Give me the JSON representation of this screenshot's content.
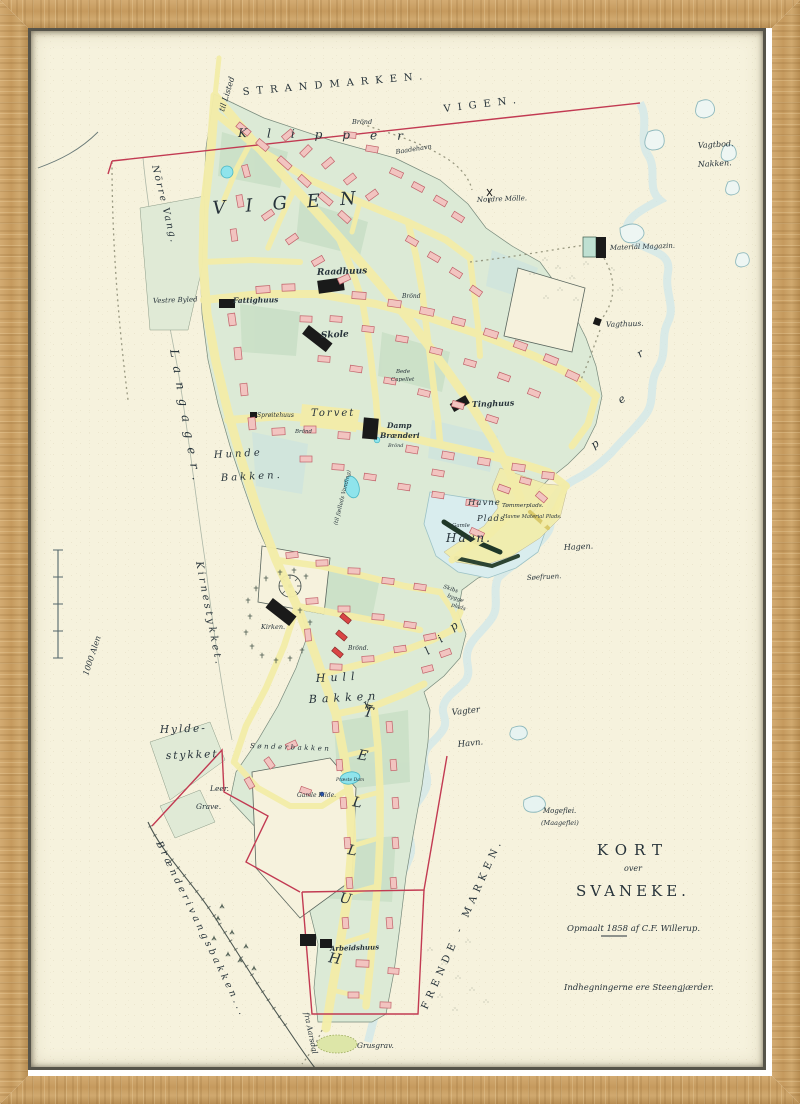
{
  "artwork": {
    "type": "framed antique town map",
    "town": "Svaneke",
    "year": "1858"
  },
  "palette": {
    "wood": "#c59a62",
    "paper": "#f6f2dd",
    "street": "#f3eda9",
    "block": "#dcead6",
    "block_dark": "#c9dfc6",
    "block_teal": "#cfe4dd",
    "building_pink": "#f2c4c0",
    "building_pink_stroke": "#c2626a",
    "building_red": "#d94545",
    "landmark_black": "#1a1a1a",
    "water_wash": "#cfe7ea",
    "water_line": "#8fb9bd",
    "boundary_red": "#c23a52",
    "pond_cyan": "#8fe4ec",
    "ink": "#27333a"
  },
  "scale_bar": {
    "label": "1000 Alen"
  },
  "title_block": {
    "line1": "KORT",
    "line2": "over",
    "line3": "SVANEKE.",
    "surveyed": "Opmaalt 1858 af C.F. Willerup.",
    "note": "Indhegningerne ere Steengjærder."
  },
  "map": {
    "labels": [
      {
        "id": "strandmarken",
        "text": "STRANDMARKEN.",
        "x": 243,
        "y": 95,
        "s": 10,
        "r": -5,
        "ls": 7,
        "c": "caps"
      },
      {
        "id": "til-listed",
        "text": "til Listed",
        "x": 224,
        "y": 112,
        "s": 8,
        "r": -73,
        "c": "script"
      },
      {
        "id": "klipper-north",
        "text": "Klipper",
        "x": 238,
        "y": 137,
        "s": 12,
        "r": 1,
        "ls": 20,
        "c": "ital"
      },
      {
        "id": "vigen-north",
        "text": "VIGEN.",
        "x": 444,
        "y": 112,
        "s": 10,
        "r": -7,
        "ls": 7,
        "c": "caps"
      },
      {
        "id": "brond-north",
        "text": "Brönd",
        "x": 352,
        "y": 124,
        "s": 6.5,
        "c": "script"
      },
      {
        "id": "baadehavn",
        "text": "Baadehavn",
        "x": 396,
        "y": 154,
        "s": 6.5,
        "r": -9,
        "c": "script"
      },
      {
        "id": "vagtbod",
        "text": "Vagtbod.",
        "x": 698,
        "y": 148,
        "s": 8,
        "r": -3,
        "c": "script"
      },
      {
        "id": "nakken",
        "text": "Nakken.",
        "x": 698,
        "y": 167,
        "s": 8,
        "r": -3,
        "c": "script"
      },
      {
        "id": "norre-vang",
        "text": "Nörre Vang.",
        "x": 152,
        "y": 166,
        "s": 9.5,
        "r": 76,
        "ls": 2,
        "c": "script"
      },
      {
        "id": "vigen-town",
        "text": "VIGEN",
        "x": 213,
        "y": 214,
        "s": 18,
        "r": -4,
        "ls": 20,
        "c": "ital"
      },
      {
        "id": "nordre-molle",
        "text": "Nordre Mölle.",
        "x": 477,
        "y": 202,
        "s": 7,
        "r": -2,
        "c": "script"
      },
      {
        "id": "material-magazin",
        "text": "Materiál Magazin.",
        "x": 610,
        "y": 250,
        "s": 7,
        "r": -2,
        "c": "script"
      },
      {
        "id": "langager",
        "text": "Langager.",
        "x": 170,
        "y": 350,
        "s": 12,
        "r": 80,
        "ls": 9,
        "c": "script"
      },
      {
        "id": "vagthuus",
        "text": "Vagthuus.",
        "x": 606,
        "y": 327,
        "s": 7.5,
        "r": -2,
        "c": "script"
      },
      {
        "id": "raadhuus",
        "text": "Raadhuus",
        "x": 317,
        "y": 275,
        "s": 9,
        "r": -2,
        "c": "scriptb"
      },
      {
        "id": "vestre-byled",
        "text": "Vestre Byled",
        "x": 153,
        "y": 303,
        "s": 7,
        "r": -2,
        "c": "script"
      },
      {
        "id": "fattighuus",
        "text": "Fattighuus",
        "x": 233,
        "y": 303,
        "s": 7.5,
        "r": -1,
        "c": "scriptb"
      },
      {
        "id": "skole",
        "text": "Skole",
        "x": 321,
        "y": 338,
        "s": 9,
        "r": -3,
        "c": "scriptb"
      },
      {
        "id": "brond-1",
        "text": "Brönd",
        "x": 402,
        "y": 298,
        "s": 6,
        "c": "script"
      },
      {
        "id": "bede",
        "text": "Bede",
        "x": 396,
        "y": 373,
        "s": 5.5,
        "c": "script"
      },
      {
        "id": "capellet",
        "text": "Capellet",
        "x": 391,
        "y": 381,
        "s": 5.5,
        "c": "script"
      },
      {
        "id": "sproitehuus",
        "text": "Sprøitehuus",
        "x": 257,
        "y": 417,
        "s": 6,
        "c": "script"
      },
      {
        "id": "torvet",
        "text": "Torvet",
        "x": 311,
        "y": 416,
        "s": 10,
        "ls": 2,
        "c": "ital"
      },
      {
        "id": "brond-2",
        "text": "Brönd",
        "x": 295,
        "y": 433,
        "s": 5.5,
        "c": "script"
      },
      {
        "id": "hunde",
        "text": "Hunde",
        "x": 214,
        "y": 458,
        "s": 10,
        "ls": 3,
        "r": -3,
        "c": "ital"
      },
      {
        "id": "bakken-1",
        "text": "Bakken.",
        "x": 221,
        "y": 481,
        "s": 10,
        "ls": 3,
        "r": -3,
        "c": "ital"
      },
      {
        "id": "tinghuus",
        "text": "Tinghuus",
        "x": 472,
        "y": 407,
        "s": 8,
        "r": -2,
        "c": "scriptb"
      },
      {
        "id": "damp",
        "text": "Damp",
        "x": 387,
        "y": 428,
        "s": 7.5,
        "c": "scriptb"
      },
      {
        "id": "branderi",
        "text": "Brænderi",
        "x": 380,
        "y": 438,
        "s": 7.5,
        "c": "scriptb"
      },
      {
        "id": "brond-3",
        "text": "Brönd",
        "x": 388,
        "y": 447,
        "s": 5,
        "c": "script"
      },
      {
        "id": "faelleds",
        "text": "(til fælleds Vanding)",
        "x": 344,
        "y": 498,
        "s": 5.5,
        "r": -76,
        "a": "middle",
        "c": "script"
      },
      {
        "id": "havne",
        "text": "Havne",
        "x": 468,
        "y": 505,
        "s": 8.5,
        "ls": 1,
        "c": "ital"
      },
      {
        "id": "plads-1",
        "text": "Plads",
        "x": 477,
        "y": 521,
        "s": 8.5,
        "ls": 1,
        "c": "ital"
      },
      {
        "id": "tommerplads",
        "text": "Tømmerplads.",
        "x": 502,
        "y": 507,
        "s": 5.8,
        "c": "script"
      },
      {
        "id": "havne-material",
        "text": "Havne Material Plads.",
        "x": 503,
        "y": 518,
        "s": 5.2,
        "c": "script"
      },
      {
        "id": "gamle",
        "text": "Gamle",
        "x": 452,
        "y": 527,
        "s": 5.5,
        "c": "script"
      },
      {
        "id": "havn-big",
        "text": "Havn.",
        "x": 446,
        "y": 542,
        "s": 12,
        "ls": 2,
        "c": "ital"
      },
      {
        "id": "hagen",
        "text": "Hagen.",
        "x": 564,
        "y": 550,
        "s": 8,
        "r": -3,
        "c": "script"
      },
      {
        "id": "soefruen",
        "text": "Søefruen.",
        "x": 527,
        "y": 580,
        "s": 7,
        "r": -3,
        "c": "script"
      },
      {
        "id": "skibs",
        "text": "Skibs",
        "x": 443,
        "y": 588,
        "s": 5.5,
        "r": 18,
        "c": "script"
      },
      {
        "id": "bygge",
        "text": "bygge",
        "x": 447,
        "y": 597,
        "s": 5.5,
        "r": 18,
        "c": "script"
      },
      {
        "id": "plads-2",
        "text": "plads",
        "x": 451,
        "y": 606,
        "s": 5.5,
        "r": 18,
        "c": "script"
      },
      {
        "id": "klip-K",
        "text": "K",
        "x": 367,
        "y": 710,
        "s": 11,
        "r": -35,
        "c": "ital"
      },
      {
        "id": "klip-l",
        "text": "l",
        "x": 428,
        "y": 655,
        "s": 11,
        "r": -35,
        "c": "ital"
      },
      {
        "id": "klip-i",
        "text": "i",
        "x": 441,
        "y": 643,
        "s": 11,
        "r": -35,
        "c": "ital"
      },
      {
        "id": "klip-p1",
        "text": "p",
        "x": 453,
        "y": 631,
        "s": 11,
        "r": -35,
        "c": "ital"
      },
      {
        "id": "klip-p2",
        "text": "p",
        "x": 594,
        "y": 449,
        "s": 11,
        "r": -35,
        "c": "ital"
      },
      {
        "id": "klip-e",
        "text": "e",
        "x": 621,
        "y": 404,
        "s": 11,
        "r": -35,
        "c": "ital"
      },
      {
        "id": "klip-r",
        "text": "r",
        "x": 640,
        "y": 358,
        "s": 11,
        "r": -35,
        "c": "ital"
      },
      {
        "id": "kirken",
        "text": "Kirken.",
        "x": 261,
        "y": 629,
        "s": 6.5,
        "c": "script"
      },
      {
        "id": "brond-4",
        "text": "Brönd.",
        "x": 348,
        "y": 650,
        "s": 6,
        "c": "script"
      },
      {
        "id": "hull",
        "text": "Hull",
        "x": 316,
        "y": 682,
        "s": 11,
        "ls": 5,
        "r": -3,
        "c": "ital"
      },
      {
        "id": "bakken-2",
        "text": "Bakken",
        "x": 309,
        "y": 703,
        "s": 11,
        "ls": 5,
        "r": -3,
        "c": "ital"
      },
      {
        "id": "vagter",
        "text": "Vagter",
        "x": 452,
        "y": 715,
        "s": 8.5,
        "r": -6,
        "c": "script"
      },
      {
        "id": "havn-2",
        "text": "Havn.",
        "x": 458,
        "y": 747,
        "s": 8.5,
        "r": -6,
        "c": "script"
      },
      {
        "id": "hylde",
        "text": "Hylde-",
        "x": 160,
        "y": 733,
        "s": 10.5,
        "ls": 2,
        "r": -2,
        "c": "ital"
      },
      {
        "id": "stykket",
        "text": "stykket",
        "x": 166,
        "y": 759,
        "s": 10.5,
        "ls": 2,
        "r": -2,
        "c": "ital"
      },
      {
        "id": "sonderbakken",
        "text": "Sønderbakken",
        "x": 250,
        "y": 748,
        "s": 7,
        "ls": 2.5,
        "r": 2,
        "c": "script"
      },
      {
        "id": "leer",
        "text": "Leer.",
        "x": 210,
        "y": 791,
        "s": 7.5,
        "c": "script"
      },
      {
        "id": "grave",
        "text": "Grave.",
        "x": 196,
        "y": 809,
        "s": 7.5,
        "c": "script"
      },
      {
        "id": "praeste-dam",
        "text": "Præste Dam",
        "x": 336,
        "y": 781,
        "s": 4.5,
        "c": "script"
      },
      {
        "id": "kilde",
        "text": "Gamle Kilde.",
        "x": 297,
        "y": 797,
        "s": 6,
        "c": "script"
      },
      {
        "id": "kirnestykket",
        "text": "Kirnestykket.",
        "x": 196,
        "y": 562,
        "s": 10,
        "r": 79,
        "ls": 3,
        "c": "script"
      },
      {
        "id": "hullet-T",
        "text": "T",
        "x": 363,
        "y": 716,
        "s": 14,
        "r": 10,
        "c": "ital"
      },
      {
        "id": "hullet-E",
        "text": "E",
        "x": 357,
        "y": 759,
        "s": 14,
        "r": 10,
        "c": "ital"
      },
      {
        "id": "hullet-L1",
        "text": "L",
        "x": 352,
        "y": 806,
        "s": 14,
        "r": 10,
        "c": "ital"
      },
      {
        "id": "hullet-L2",
        "text": "L",
        "x": 347,
        "y": 854,
        "s": 14,
        "r": 10,
        "c": "ital"
      },
      {
        "id": "hullet-U",
        "text": "U",
        "x": 339,
        "y": 902,
        "s": 14,
        "r": 10,
        "c": "ital"
      },
      {
        "id": "hullet-H",
        "text": "H",
        "x": 328,
        "y": 962,
        "s": 14,
        "r": 10,
        "c": "ital"
      },
      {
        "id": "frende-marken",
        "text": "FRENDE - MARKEN.",
        "x": 427,
        "y": 1010,
        "s": 10,
        "r": -66,
        "ls": 5,
        "c": "caps"
      },
      {
        "id": "mogeflei",
        "text": "Mogeflei.",
        "x": 543,
        "y": 813,
        "s": 7,
        "c": "script"
      },
      {
        "id": "maageflei",
        "text": "(Maageflei)",
        "x": 541,
        "y": 825,
        "s": 6.5,
        "c": "script"
      },
      {
        "id": "branderivang",
        "text": "Brænderivangsbakken...",
        "x": 156,
        "y": 843,
        "s": 9.5,
        "r": 64,
        "ls": 3.5,
        "c": "script"
      },
      {
        "id": "fra-aarsdal",
        "text": "fra Aarsdal",
        "x": 304,
        "y": 1013,
        "s": 7.5,
        "r": 78,
        "c": "script"
      },
      {
        "id": "arbeidshuus",
        "text": "Arbeidshuus",
        "x": 330,
        "y": 951,
        "s": 7,
        "r": -2,
        "c": "scriptb"
      },
      {
        "id": "grusgrav",
        "text": "Grusgrav.",
        "x": 357,
        "y": 1048,
        "s": 7.5,
        "c": "script"
      },
      {
        "id": "kort",
        "text": "KORT",
        "x": 633,
        "y": 855,
        "s": 15,
        "ls": 7,
        "a": "middle",
        "c": "caps"
      },
      {
        "id": "over",
        "text": "over",
        "x": 633,
        "y": 871,
        "s": 8,
        "a": "middle",
        "c": "script"
      },
      {
        "id": "svaneke",
        "text": "SVANEKE.",
        "x": 633,
        "y": 896,
        "s": 15,
        "ls": 4,
        "a": "middle",
        "c": "caps"
      },
      {
        "id": "opmaalt",
        "text": "Opmaalt 1858 af C.F. Willerup.",
        "x": 567,
        "y": 931,
        "s": 8.5,
        "c": "script"
      },
      {
        "id": "indhegning",
        "text": "Indhegningerne ere Steengjærder.",
        "x": 564,
        "y": 990,
        "s": 8.5,
        "c": "script"
      },
      {
        "id": "alen",
        "text": "1000 Alen",
        "x": 88,
        "y": 676,
        "s": 8,
        "r": -72,
        "c": "script"
      }
    ]
  }
}
